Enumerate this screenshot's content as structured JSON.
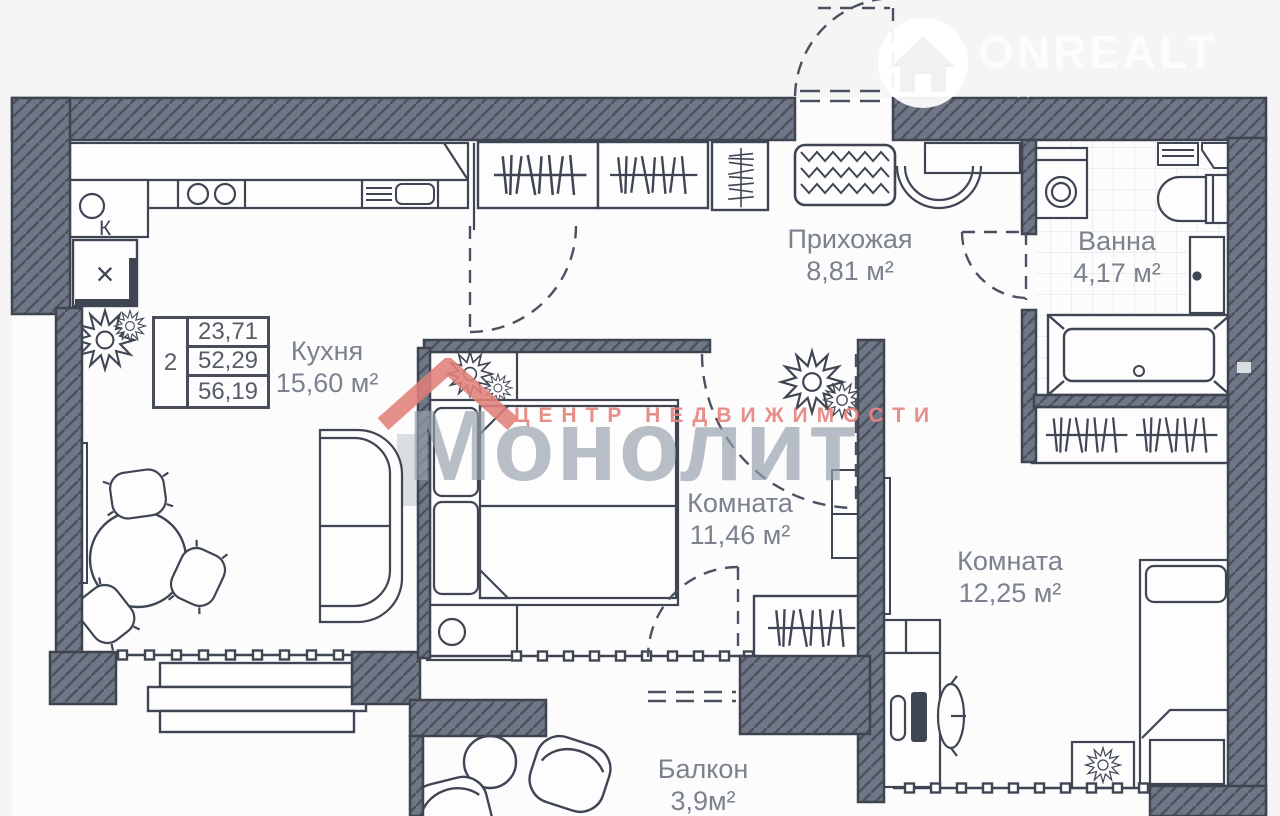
{
  "brand_logo": {
    "name": "ONREALT",
    "tagline": "НЕДВИЖИМОСТЬ"
  },
  "watermark": {
    "title": "Монолит",
    "subtitle": "ЦЕНТР  НЕДВИЖИМОСТИ"
  },
  "summary_table": {
    "rooms_count": "2",
    "values": [
      "23,71",
      "52,29",
      "56,19"
    ]
  },
  "rooms": [
    {
      "id": "kitchen",
      "name": "Кухня",
      "area": "15,60 м²"
    },
    {
      "id": "hallway",
      "name": "Прихожая",
      "area": "8,81 м²"
    },
    {
      "id": "bathroom",
      "name": "Ванна",
      "area": "4,17 м²"
    },
    {
      "id": "bedroom",
      "name": "Комната",
      "area": "11,46 м²"
    },
    {
      "id": "room2",
      "name": "Комната",
      "area": "12,25 м²"
    },
    {
      "id": "balcony",
      "name": "Балкон",
      "area": "3,9м²"
    }
  ],
  "plan_marks": {
    "kitchen_riser": "К",
    "vent_shaft": "×"
  },
  "colors": {
    "wall": "#6f7686",
    "line": "#3f4553",
    "label": "#7b828d",
    "accent_red": "#e2837e",
    "watermark_gray": "#979fab"
  }
}
